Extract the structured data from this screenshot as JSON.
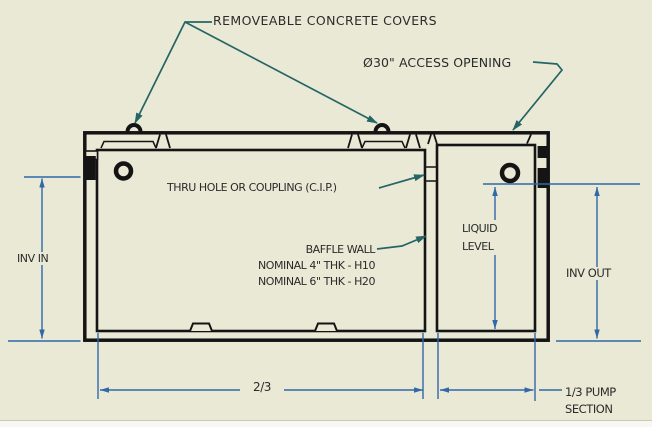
{
  "labels": {
    "covers": "REMOVEABLE CONCRETE COVERS",
    "access": "Ø30\" ACCESS OPENING",
    "thru_hole": "THRU HOLE OR COUPLING (C.I.P.)",
    "baffle_wall": "BAFFLE WALL",
    "baffle_thk_h10": "NOMINAL 4\" THK - H10",
    "baffle_thk_h20": "NOMINAL 6\" THK - H20",
    "inv_in": "INV IN",
    "liquid_line1": "LIQUID",
    "liquid_line2": "LEVEL",
    "inv_out": "INV OUT",
    "dim_main": "2/3",
    "dim_pump_line1": "1/3 PUMP",
    "dim_pump_line2": "SECTION"
  },
  "colors": {
    "bg": "#e9e9d6",
    "ink": "#141414",
    "dim": "#3068a8",
    "leader": "#256565",
    "text": "#2b2b2b",
    "strip": "#f7f8f1",
    "stripline": "#c9c9bb"
  }
}
